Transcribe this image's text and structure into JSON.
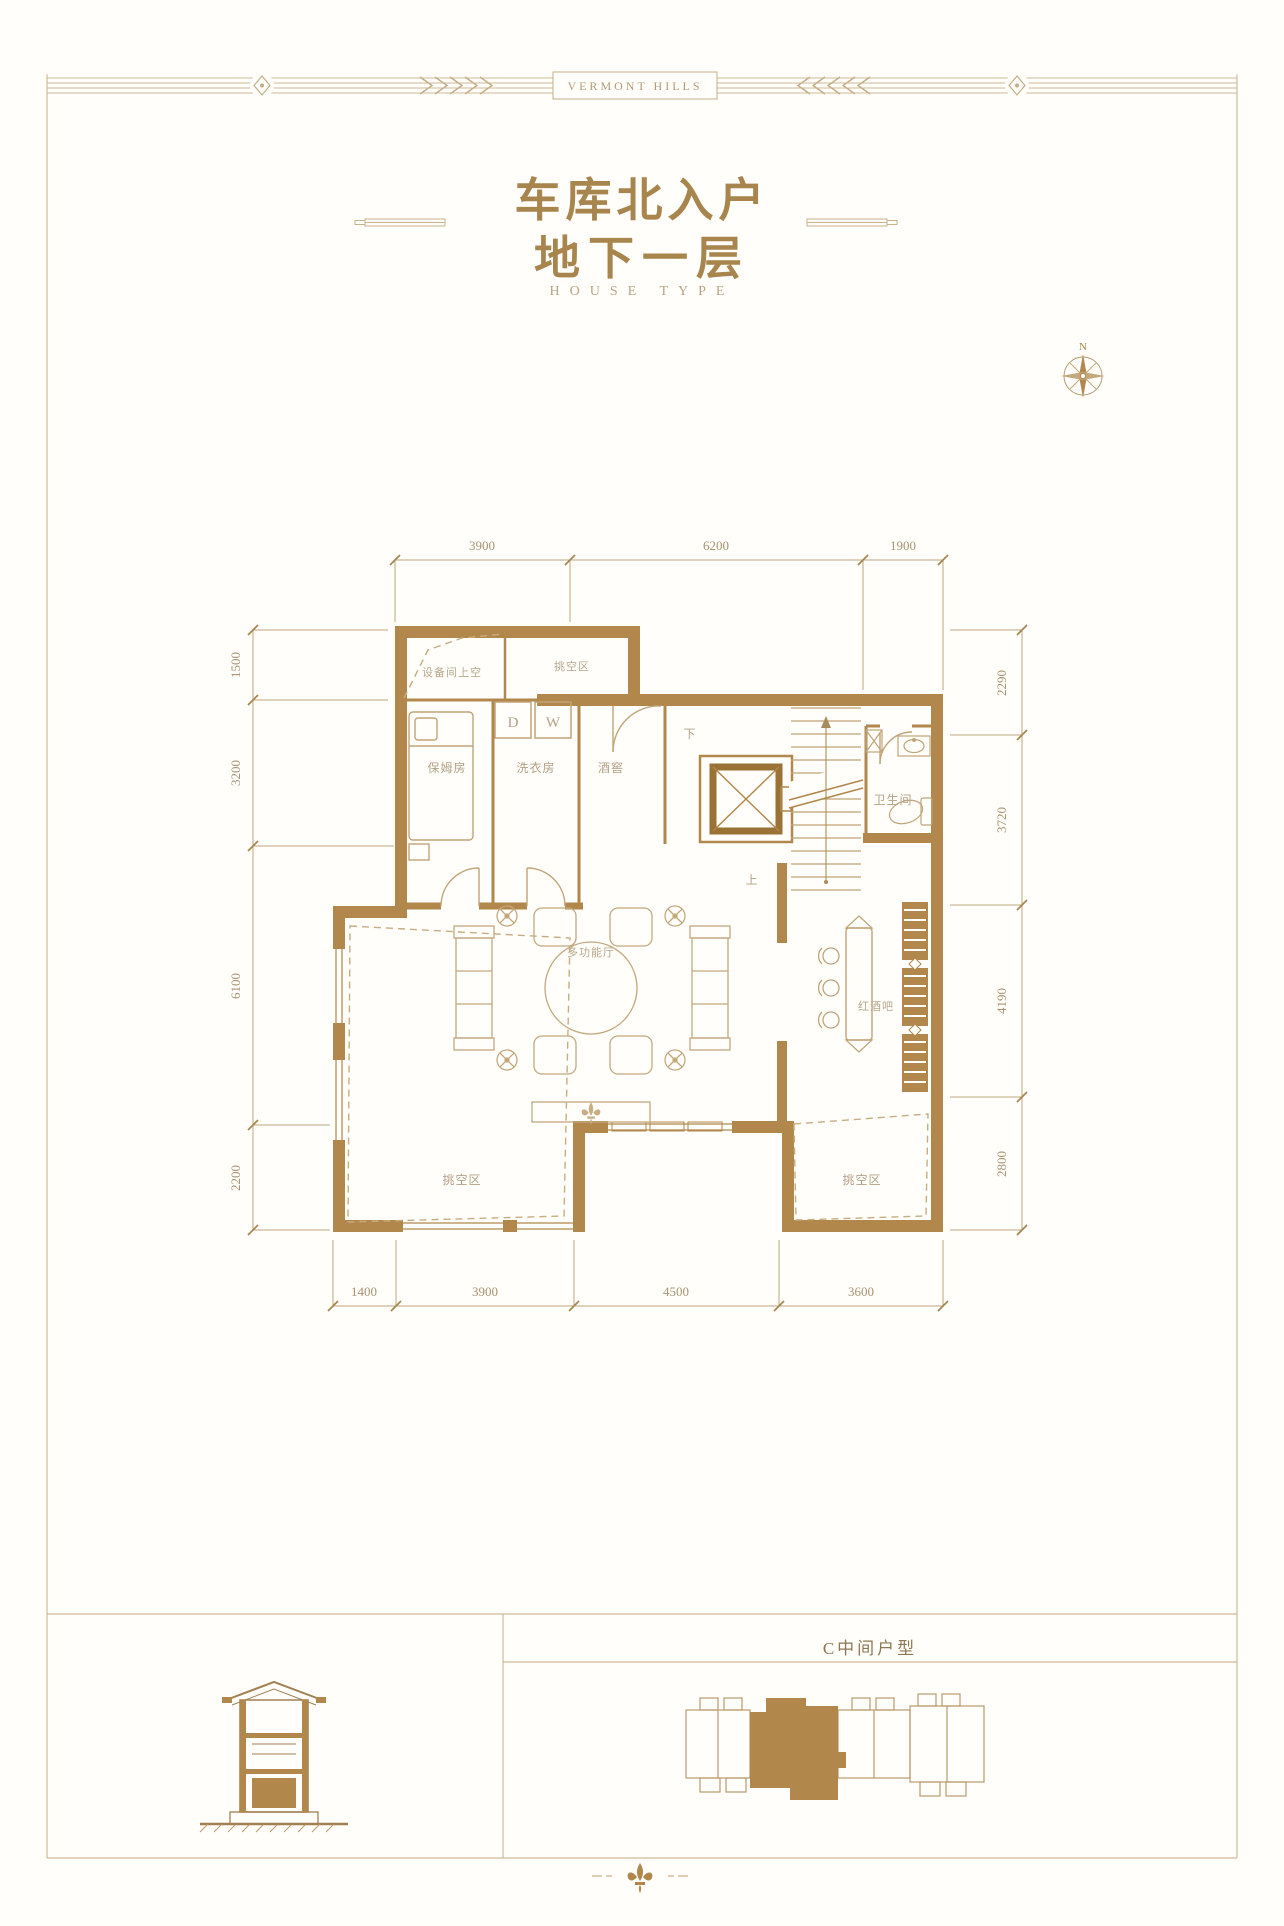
{
  "banner": {
    "brand": "VERMONT HILLS"
  },
  "title": {
    "line1": "车库北入户",
    "line2": "地下一层",
    "subtitle": "HOUSE TYPE"
  },
  "compass": {
    "north": "N"
  },
  "plan": {
    "rooms": {
      "equipment_void": "设备间上空",
      "void_top": "挑空区",
      "nanny_room": "保姆房",
      "laundry": "洗衣房",
      "wine_cellar": "酒窖",
      "bathroom": "卫生间",
      "multi_hall": "多功能厅",
      "wine_bar": "红酒吧",
      "void_bottom_left": "挑空区",
      "void_bottom_right": "挑空区"
    },
    "appliances": {
      "dryer": "D",
      "washer": "W"
    },
    "stairs": {
      "down": "下",
      "up": "上"
    },
    "dims": {
      "top": [
        "3900",
        "6200",
        "1900"
      ],
      "bottom": [
        "1400",
        "3900",
        "4500",
        "3600"
      ],
      "left": [
        "1500",
        "3200",
        "6100",
        "2200"
      ],
      "right": [
        "2290",
        "3720",
        "4190",
        "2800"
      ]
    }
  },
  "footer": {
    "unit_label": "C中间户型"
  },
  "colors": {
    "wall": "#b1874b",
    "line": "#c6b18c",
    "title": "#a9854e",
    "label": "#b3a084",
    "dim": "#a89270"
  }
}
